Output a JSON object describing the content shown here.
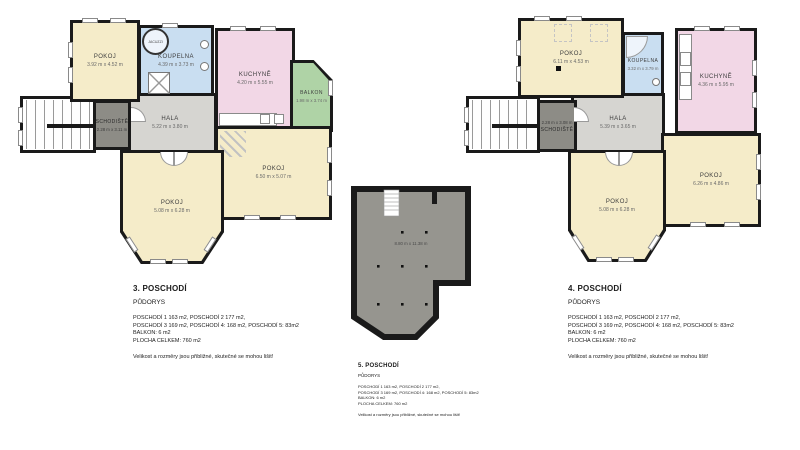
{
  "page": {
    "background": "#ffffff"
  },
  "colors": {
    "wall": "#1a1a1a",
    "room_cream": "#f5ecc9",
    "room_blue": "#c9def1",
    "room_pink": "#f2d7e6",
    "room_green": "#afd3a6",
    "room_gray_light": "#d6d5d1",
    "room_gray_dark": "#8d8c86",
    "attic_gray": "#96958f"
  },
  "plans": [
    {
      "title": "3. POSCHODÍ",
      "subtitle": "PŮDORYS",
      "area_lines": [
        "POSCHODÍ 1 163 m2, POSCHODÍ 2 177 m2,",
        "POSCHODÍ 3 169 m2, POSCHODÍ 4: 168 m2, POSCHODÍ 5: 83m2",
        "BALKON: 6 m2",
        "PLOCHA CELKEM: 760 m2"
      ],
      "disclaimer": "Velikost a rozměry jsou přibližné, skutečné se mohou lišit!",
      "rooms": {
        "pokoj_top": {
          "label": "POKOJ",
          "dims": "3.92 m x 4.52 m"
        },
        "koupelna": {
          "label": "KOUPELNA",
          "dims": "4.39 m x 3.73 m"
        },
        "jacuzzi": {
          "label": "JACUZZI"
        },
        "kuchyne": {
          "label": "KUCHYNĚ",
          "dims": "4.20 m x 5.55 m"
        },
        "balkon": {
          "label": "BALKON",
          "dims": "1.98 m x 3.74 m"
        },
        "schodiste": {
          "label": "SCHODIŠTĚ",
          "dims": "2.28 m x 3.11 m"
        },
        "hala": {
          "label": "HALA",
          "dims": "5.22 m x 3.80 m"
        },
        "pokoj_left": {
          "label": "POKOJ",
          "dims": "5.08 m x 6.28 m"
        },
        "pokoj_right": {
          "label": "POKOJ",
          "dims": "6.50 m x 5.07 m"
        }
      }
    },
    {
      "title": "4. POSCHODÍ",
      "subtitle": "PŮDORYS",
      "area_lines": [
        "POSCHODÍ 1 163 m2, POSCHODÍ 2 177 m2,",
        "POSCHODÍ 3 169 m2, POSCHODÍ 4: 168 m2, POSCHODÍ 5: 83m2",
        "BALKON: 6 m2",
        "PLOCHA CELKEM: 760 m2"
      ],
      "disclaimer": "Velikost a rozměry jsou přibližné, skutečné se mohou lišit!",
      "rooms": {
        "pokoj_top": {
          "label": "POKOJ",
          "dims": "6.11 m x 4.53 m"
        },
        "koupelna": {
          "label": "KOUPELNA",
          "dims": "3.32 m x 3.79 m"
        },
        "kuchyne": {
          "label": "KUCHYNĚ",
          "dims": "4.36 m x 5.95 m"
        },
        "schodiste": {
          "label": "SCHODIŠTĚ",
          "dims": "2.28 m x 3.08 m"
        },
        "hala": {
          "label": "HALA",
          "dims": "5.39 m x 3.65 m"
        },
        "pokoj_left": {
          "label": "POKOJ",
          "dims": "5.08 m x 6.28 m"
        },
        "pokoj_right": {
          "label": "POKOJ",
          "dims": "6.26 m x 4.86 m"
        }
      }
    },
    {
      "title": "5. POSCHODÍ",
      "subtitle": "PŮDORYS",
      "area_lines": [
        "POSCHODÍ 1 163 m2, POSCHODÍ 2 177 m2,",
        "POSCHODÍ 3 169 m2, POSCHODÍ 4: 168 m2, POSCHODÍ 5: 83m2",
        "BALKON: 6 m2",
        "PLOCHA CELKEM: 760 m2"
      ],
      "disclaimer": "Velikost a rozměry jsou přibližné, skutečné se mohou lišit!",
      "rooms": {
        "attic": {
          "dims": "8.80 m x 11.38 m"
        }
      }
    }
  ]
}
